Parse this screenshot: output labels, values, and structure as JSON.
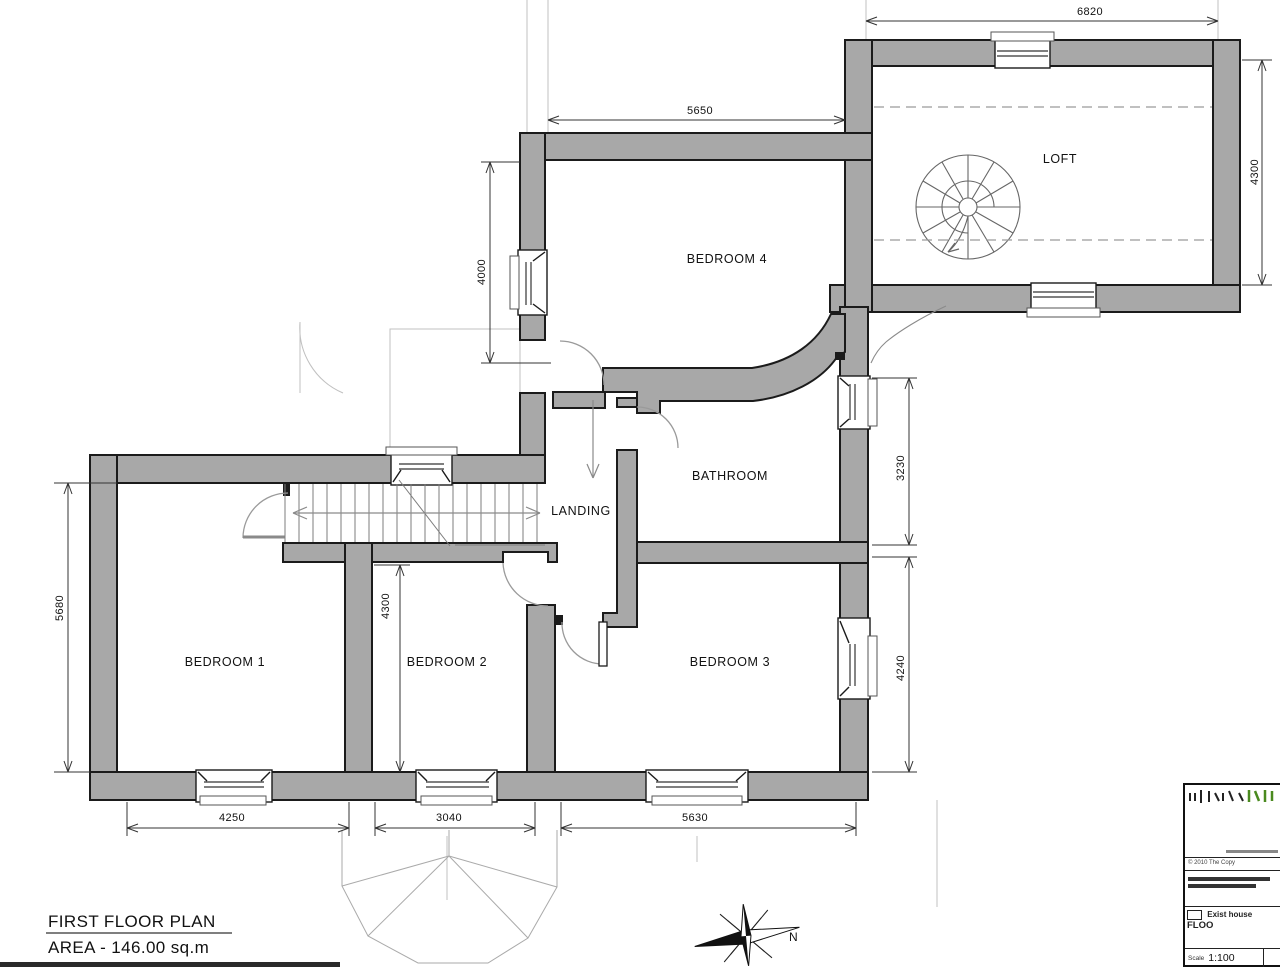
{
  "plan": {
    "title": "FIRST FLOOR PLAN",
    "area_label": "AREA - 146.00 sq.m",
    "rooms": {
      "loft": "LOFT",
      "bedroom4": "BEDROOM 4",
      "bathroom": "BATHROOM",
      "landing": "LANDING",
      "bedroom1": "BEDROOM 1",
      "bedroom2": "BEDROOM 2",
      "bedroom3": "BEDROOM 3"
    },
    "dimensions": {
      "loft_width": "6820",
      "loft_depth": "4300",
      "bedroom4_width": "5650",
      "bedroom4_depth": "4000",
      "bathroom_depth": "3230",
      "bedroom3_depth": "4240",
      "bedroom1_depth": "5680",
      "bedroom2_depth": "4300",
      "bedroom1_width": "4250",
      "bedroom2_width": "3040",
      "bedroom3_width": "5630"
    },
    "compass_north": "N",
    "colors": {
      "wall_fill": "#a8a8a8",
      "wall_line": "#1b1b1b",
      "faint_line": "#b8b8b8",
      "logo_accent": "#4a8a1f"
    }
  },
  "title_block": {
    "copyright": "© 2010 The Copy",
    "project": "Exist house",
    "sheet": "FLOO",
    "scale_label": "Scale",
    "scale_value": "1:100"
  }
}
